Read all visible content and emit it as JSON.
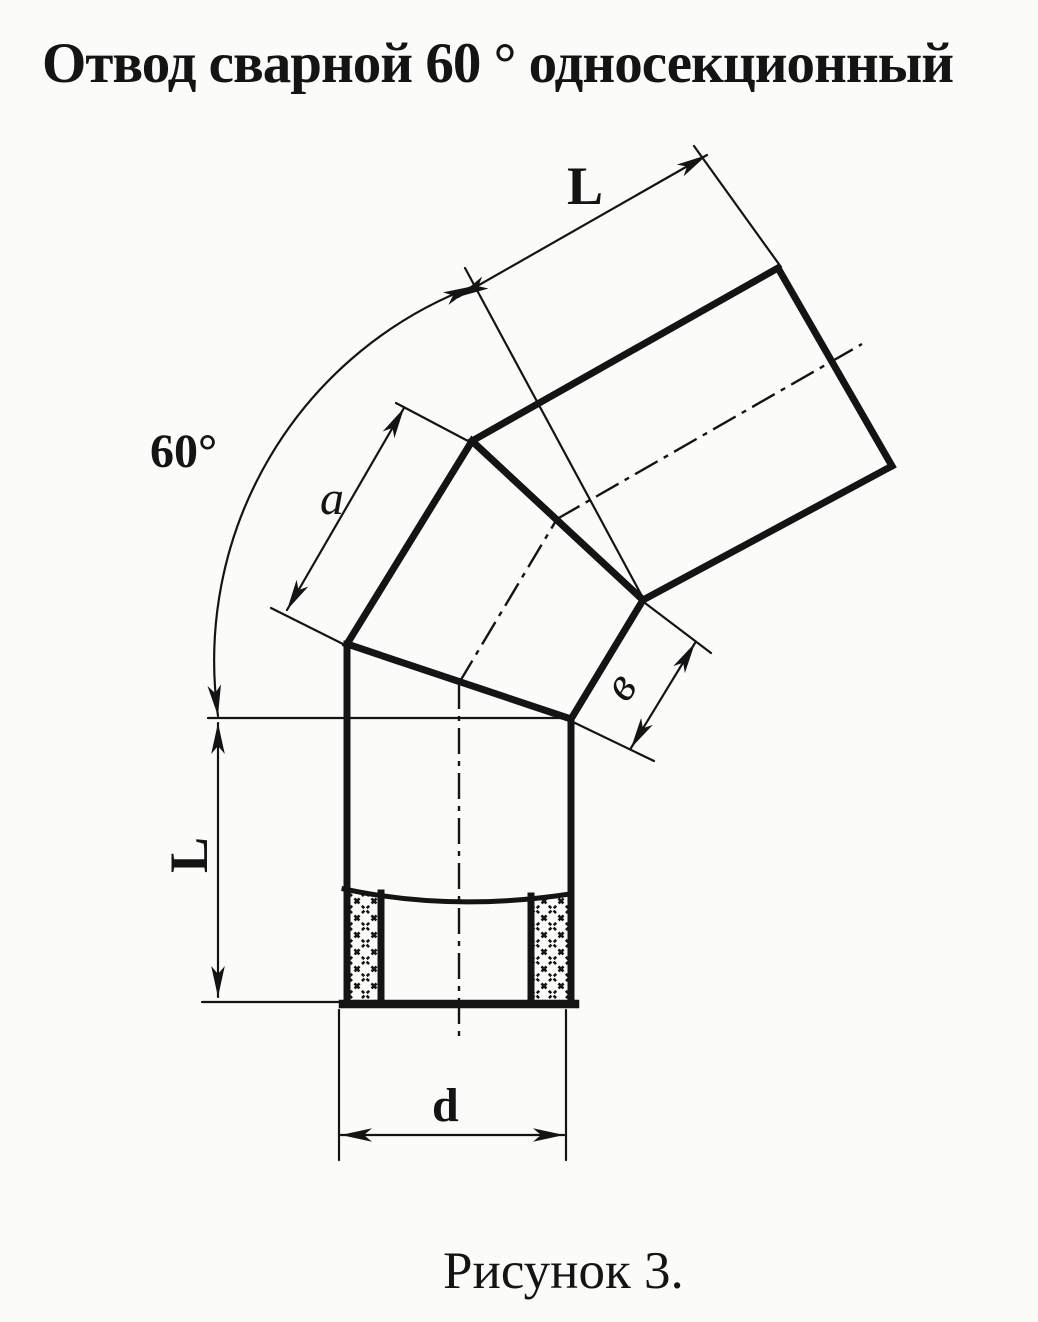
{
  "title": "Отвод сварной 60 ° односекционный",
  "caption": "Рисунок 3.",
  "labels": {
    "angle": "60°",
    "length_top": "L",
    "length_bottom": "L",
    "section_long_side": "a",
    "section_short_side": "в",
    "diameter": "d"
  },
  "colors": {
    "ink": "#141414",
    "paper": "#fbfbf9"
  }
}
